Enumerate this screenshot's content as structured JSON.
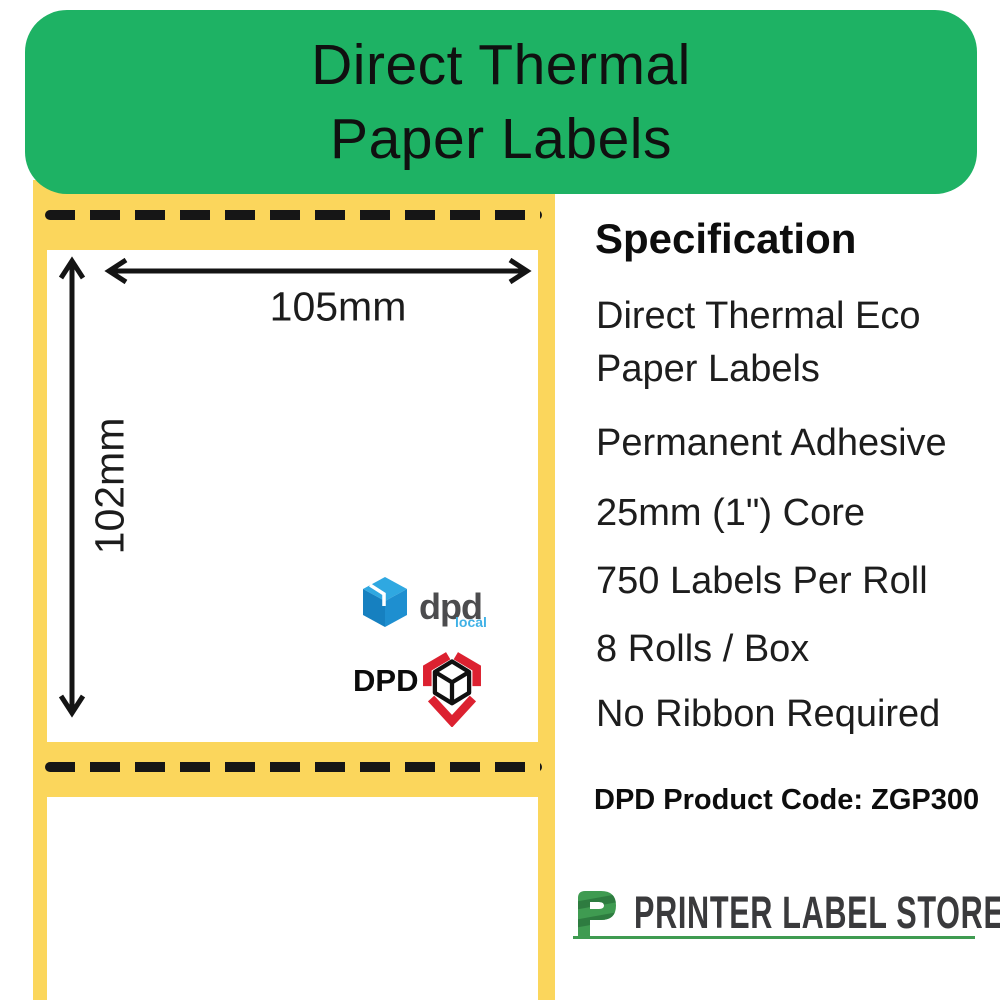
{
  "header": {
    "title_line1": "Direct Thermal",
    "title_line2": "Paper Labels"
  },
  "diagram": {
    "width_dimension": "105mm",
    "height_dimension": "102mm",
    "dpd_local_logo": {
      "wordmark": "dpd",
      "tagline": "local"
    },
    "dpd_logo": {
      "wordmark": "DPD"
    }
  },
  "specification": {
    "heading": "Specification",
    "items": [
      "Direct Thermal Eco Paper Labels",
      "Permanent Adhesive",
      "25mm (1\") Core",
      "750 Labels Per Roll",
      "8 Rolls / Box",
      "No Ribbon Required"
    ],
    "product_code": "DPD Product Code: ZGP300"
  },
  "footer": {
    "brand": "PRINTER LABEL STORE"
  },
  "colors": {
    "banner_green": "#1eb264",
    "backing_yellow": "#fbd65c",
    "dpd_red": "#dc2130",
    "dpd_blue": "#1e8fd0",
    "brand_green": "#3f9b51"
  }
}
